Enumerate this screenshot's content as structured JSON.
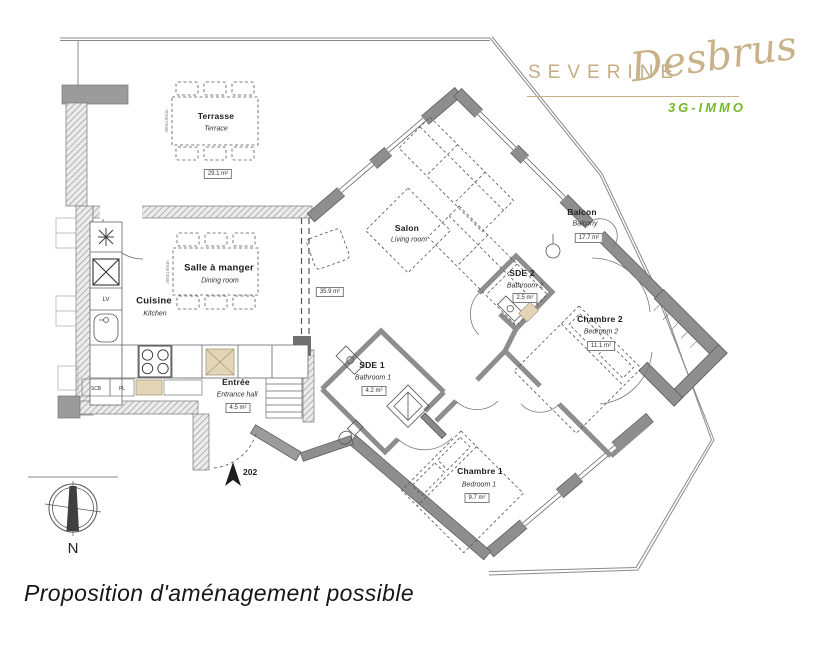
{
  "logo": {
    "first_name": "SEVERINE",
    "last_name": "Desbrus",
    "brand": "3G-IMMO",
    "name_color": "#c4ad85",
    "brand_color": "#76b82a"
  },
  "caption": "Proposition d'aménagement possible",
  "unit_number": "202",
  "compass_label": "N",
  "rooms": {
    "terrasse": {
      "fr": "Terrasse",
      "en": "Terrace",
      "area": "29.1 m²"
    },
    "dining": {
      "fr": "Salle à manger",
      "en": "Dining room"
    },
    "cuisine": {
      "fr": "Cuisine",
      "en": "Kitchen"
    },
    "salon": {
      "fr": "Salon",
      "en": "Living room",
      "area": "35.9 m²"
    },
    "balcon": {
      "fr": "Balcon",
      "en": "Balcony",
      "area": "17.7 m²"
    },
    "sde2": {
      "fr": "SDE 2",
      "en": "Bathroom 2",
      "area": "2.5 m²"
    },
    "chambre2": {
      "fr": "Chambre 2",
      "en": "Bedroom 2",
      "area": "11.1 m²"
    },
    "sde1": {
      "fr": "SDE 1",
      "en": "Bathroom 1",
      "area": "4.2 m²"
    },
    "entree": {
      "fr": "Entrée",
      "en": "Entrance hall",
      "area": "4.5 m²"
    },
    "chambre1": {
      "fr": "Chambre 1",
      "en": "Bedroom 1",
      "area": "9.7 m²"
    }
  },
  "kitchen_labels": {
    "dishwasher": "LV",
    "scb": "SCB",
    "pl": "PL"
  },
  "furniture": {
    "table_size": "300x190cm"
  },
  "colors": {
    "wall": "#8e8e8e",
    "line": "#555555"
  }
}
